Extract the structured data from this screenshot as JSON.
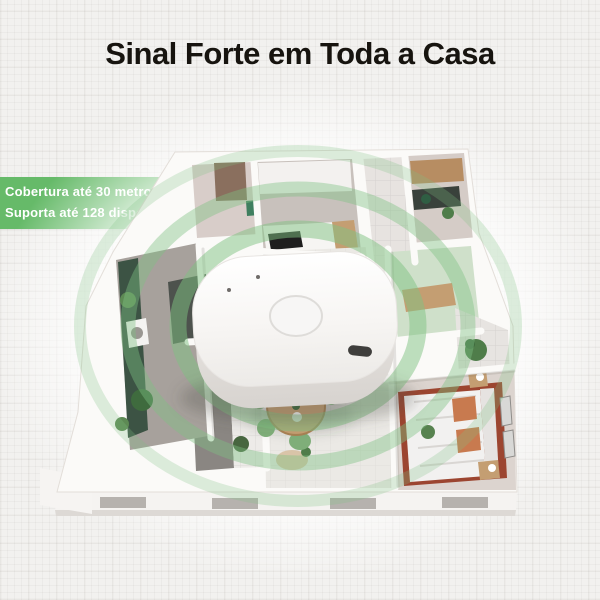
{
  "title": "Sinal Forte em Toda a Casa",
  "badge": {
    "line1": "Cobertura até 30 metros",
    "line2": "Suporta até 128 dispositivos"
  },
  "colors": {
    "badge_green": "#66ba69",
    "signal_green": "#7fc282",
    "title_text": "#17140f",
    "badge_text": "#ffffff",
    "canvas_background": "#f2f1ef",
    "accent_wood": "#c49e72",
    "bedroom_rug": "#9c4530"
  },
  "illustration": {
    "device": "white-smart-hub-gateway",
    "device_features": [
      "pairing-button",
      "usb-c-port",
      "led-holes"
    ],
    "floorplan": "3d-apartment-floorplan",
    "signal": "concentric-coverage-rings"
  }
}
